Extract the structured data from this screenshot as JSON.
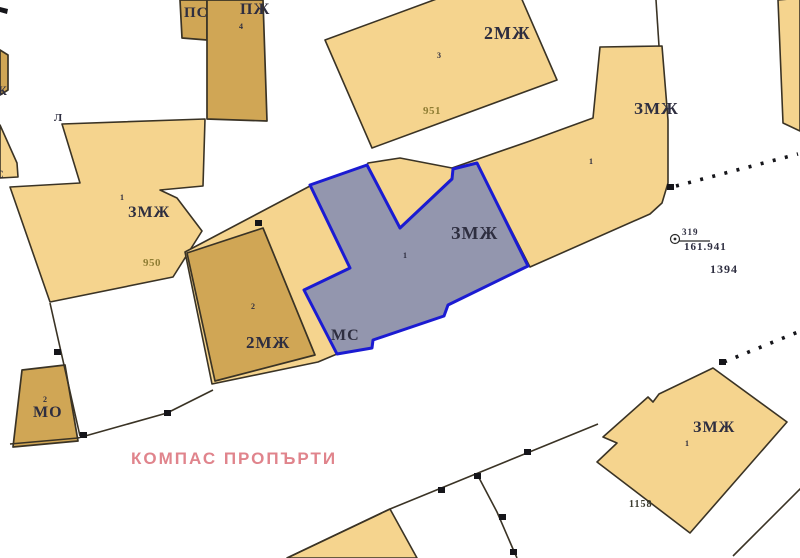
{
  "title": "cadastral-map-view",
  "colors": {
    "parcel_fill": "#f5d48e",
    "building_fill": "#d0a655",
    "selected_fill": "#9396ae",
    "selected_stroke": "#1b1bd2",
    "boundary": "#3a3325",
    "label_color": "#2e2e40",
    "number_color": "#8f7d33",
    "watermark_color": "#e0848c"
  },
  "labels": {
    "ps": "ПС",
    "pj": "ПЖ",
    "pj_num": "4",
    "top_zone": "2МЖ",
    "top_num": "3",
    "top_id": "951",
    "tr_zone": "ЗМЖ",
    "tr_num": "1",
    "sel_zone": "ЗМЖ",
    "sel_num": "1",
    "sel_ms": "МС",
    "left_zone": "ЗМЖ",
    "left_num": "1",
    "left_id": "950",
    "mid_zone": "2МЖ",
    "mid_num": "2",
    "mo": "МО",
    "mo_num": "2",
    "br_zone": "ЗМЖ",
    "br_num": "1",
    "br_id": "1158",
    "edge_l": "Л",
    "edge_zh": "Ж",
    "edge_s": "С",
    "block_id": "1394"
  },
  "survey_point": {
    "id": "319",
    "value": "161.941"
  },
  "watermark": "КОМПАС ПРОПЪРТИ"
}
